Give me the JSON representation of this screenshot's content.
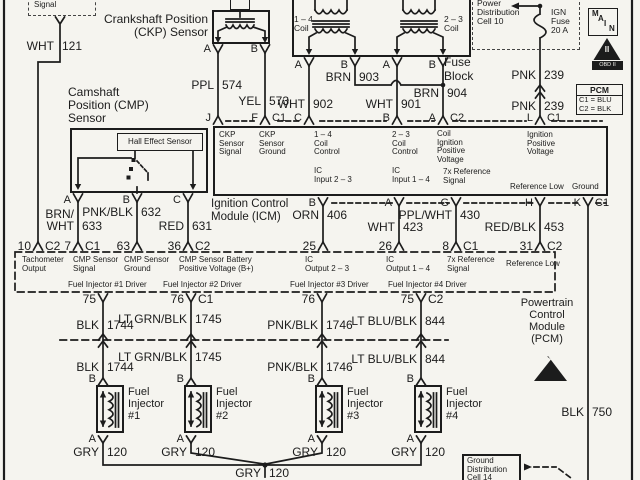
{
  "tach_box": {
    "lines": [
      "Tachometer",
      "Signal"
    ]
  },
  "ckp": {
    "title": [
      "Crankshaft Position",
      "(CKP) Sensor"
    ],
    "term_a": "A",
    "term_b": "B"
  },
  "coils": {
    "coil14": [
      "1 – 4",
      "Coil"
    ],
    "coil23": [
      "2 – 3",
      "Coil"
    ],
    "t1": "A",
    "t2": "B",
    "t3": "A",
    "t4": "B"
  },
  "cmp": {
    "title": [
      "Camshaft",
      "Position (CMP)",
      "Sensor"
    ],
    "hall": "Hall Effect Sensor",
    "t_a": "A",
    "t_b": "B",
    "t_c": "C"
  },
  "fuse": {
    "cell": [
      "Power",
      "Distribution",
      "Cell 10"
    ],
    "label": [
      "IGN",
      "Fuse",
      "20 A"
    ],
    "block": [
      "Fuse",
      "Block"
    ]
  },
  "badges": {
    "main": [
      "M",
      "A",
      "I",
      "N"
    ],
    "obd_tri": "II",
    "obd_band": "OBD II",
    "pcm_key_title": "PCM",
    "pcm_key_c1": "C1 = BLU",
    "pcm_key_c2": "C2 = BLK"
  },
  "icm": {
    "title": [
      "Ignition Control",
      "Module (ICM)"
    ],
    "pins_top": {
      "j": {
        "l": "J"
      },
      "f": {
        "l": "F",
        "c": "C1"
      },
      "c": {
        "l": "C"
      },
      "b": {
        "l": "B"
      },
      "a": {
        "l": "A",
        "c": "C2"
      },
      "lp": {
        "l": "L",
        "c": "C1"
      }
    },
    "cells": {
      "ckp_sig": [
        "CKP",
        "Sensor",
        "Signal"
      ],
      "ckp_gnd": [
        "CKP",
        "Sensor",
        "Ground"
      ],
      "coil14": [
        "1 – 4",
        "Coil",
        "Control"
      ],
      "ic23": [
        "IC",
        "Input 2 – 3"
      ],
      "coil23": [
        "2 – 3",
        "Coil",
        "Control"
      ],
      "ic14": [
        "IC",
        "Input 1 – 4"
      ],
      "coil_ign": [
        "Coil",
        "Ignition",
        "Positive",
        "Voltage"
      ],
      "ref7x": [
        "7x Reference",
        "Signal"
      ],
      "ign_pos": [
        "Ignition",
        "Positive",
        "Voltage"
      ],
      "ref_low": "Reference Low",
      "ground": "Ground"
    },
    "pins_bottom": {
      "b": {
        "l": "B"
      },
      "a": {
        "l": "A"
      },
      "g": {
        "l": "G"
      },
      "h": {
        "l": "H"
      },
      "k": {
        "l": "K",
        "c": "C1"
      }
    }
  },
  "pcm": {
    "title": [
      "Powertrain",
      "Control",
      "Module",
      "(PCM)"
    ],
    "pins_top": [
      {
        "n": "10",
        "c": "C2"
      },
      {
        "n": "7",
        "c": "C1"
      },
      {
        "n": "63"
      },
      {
        "n": "36",
        "c": "C2"
      },
      {
        "n": "25"
      },
      {
        "n": "26"
      },
      {
        "n": "8",
        "c": "C1"
      },
      {
        "n": "31",
        "c": "C2"
      }
    ],
    "cells_top": [
      [
        "Tachometer",
        "Output"
      ],
      [
        "CMP Sensor",
        "Signal"
      ],
      [
        "CMP Sensor",
        "Ground"
      ],
      [
        "CMP Sensor Battery",
        "Positive Voltage (B+)"
      ],
      [
        "IC",
        "Output 2 – 3"
      ],
      [
        "IC",
        "Output 1 – 4"
      ],
      [
        "7x Reference",
        "Signal"
      ],
      [
        "Reference Low"
      ]
    ],
    "cells_bottom": [
      "Fuel Injector #1 Driver",
      "Fuel Injector #2 Driver",
      "Fuel Injector #3 Driver",
      "Fuel Injector #4 Driver"
    ],
    "pins_bottom": [
      {
        "n": "75"
      },
      {
        "n": "76",
        "c": "C1"
      },
      {
        "n": "76"
      },
      {
        "n": "75",
        "c": "C2"
      }
    ]
  },
  "injectors": {
    "i1": [
      "Fuel",
      "Injector",
      "#1"
    ],
    "i2": [
      "Fuel",
      "Injector",
      "#2"
    ],
    "i3": [
      "Fuel",
      "Injector",
      "#3"
    ],
    "i4": [
      "Fuel",
      "Injector",
      "#4"
    ],
    "term_b": "B",
    "term_a": "A"
  },
  "ground_box": [
    "Ground",
    "Distribution",
    "Cell 14"
  ],
  "wires": {
    "wht121": {
      "c": "WHT",
      "n": "121"
    },
    "ppl574": {
      "c": "PPL",
      "n": "574"
    },
    "yel573": {
      "c": "YEL",
      "n": "573"
    },
    "wht902": {
      "c": "WHT",
      "n": "902"
    },
    "wht901": {
      "c": "WHT",
      "n": "901"
    },
    "brn903": {
      "c": "BRN",
      "n": "903"
    },
    "brn904": {
      "c": "BRN",
      "n": "904"
    },
    "pnk239": {
      "c": "PNK",
      "n": "239"
    },
    "brnwht633": {
      "c1": "BRN/",
      "c2": "WHT",
      "n": "633"
    },
    "pnkblk632": {
      "c": "PNK/BLK",
      "n": "632"
    },
    "red631": {
      "c": "RED",
      "n": "631"
    },
    "orn406": {
      "c": "ORN",
      "n": "406"
    },
    "wht423": {
      "c": "WHT",
      "n": "423"
    },
    "pplwht430": {
      "c": "PPL/WHT",
      "n": "430"
    },
    "redblk453": {
      "c": "RED/BLK",
      "n": "453"
    },
    "blk1744": {
      "c": "BLK",
      "n": "1744"
    },
    "ltgrnblk1745": {
      "c": "LT GRN/BLK",
      "n": "1745"
    },
    "pnkblk1746": {
      "c": "PNK/BLK",
      "n": "1746"
    },
    "ltblublk844": {
      "c": "LT BLU/BLK",
      "n": "844"
    },
    "gry120": {
      "c": "GRY",
      "n": "120"
    },
    "blk750": {
      "c": "BLK",
      "n": "750"
    }
  }
}
